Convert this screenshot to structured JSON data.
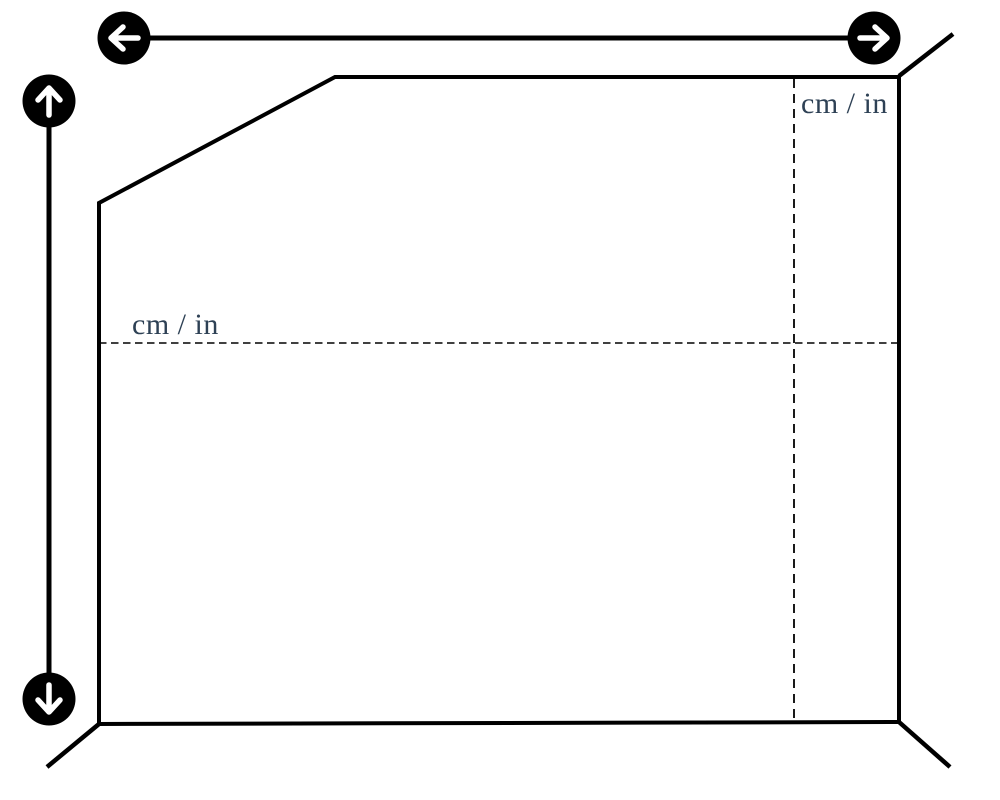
{
  "canvas": {
    "background": "#ffffff"
  },
  "colors": {
    "line": "#000000",
    "button_bg": "#000000",
    "button_arrow": "#ffffff",
    "guide_label": "#2e4155"
  },
  "width_control": {
    "decrease_icon": "arrow-left",
    "increase_icon": "arrow-right"
  },
  "height_control": {
    "increase_icon": "arrow-up",
    "decrease_icon": "arrow-down"
  },
  "guides": {
    "horizontal": {
      "label": "cm / in"
    },
    "vertical": {
      "label": "cm / in"
    }
  }
}
